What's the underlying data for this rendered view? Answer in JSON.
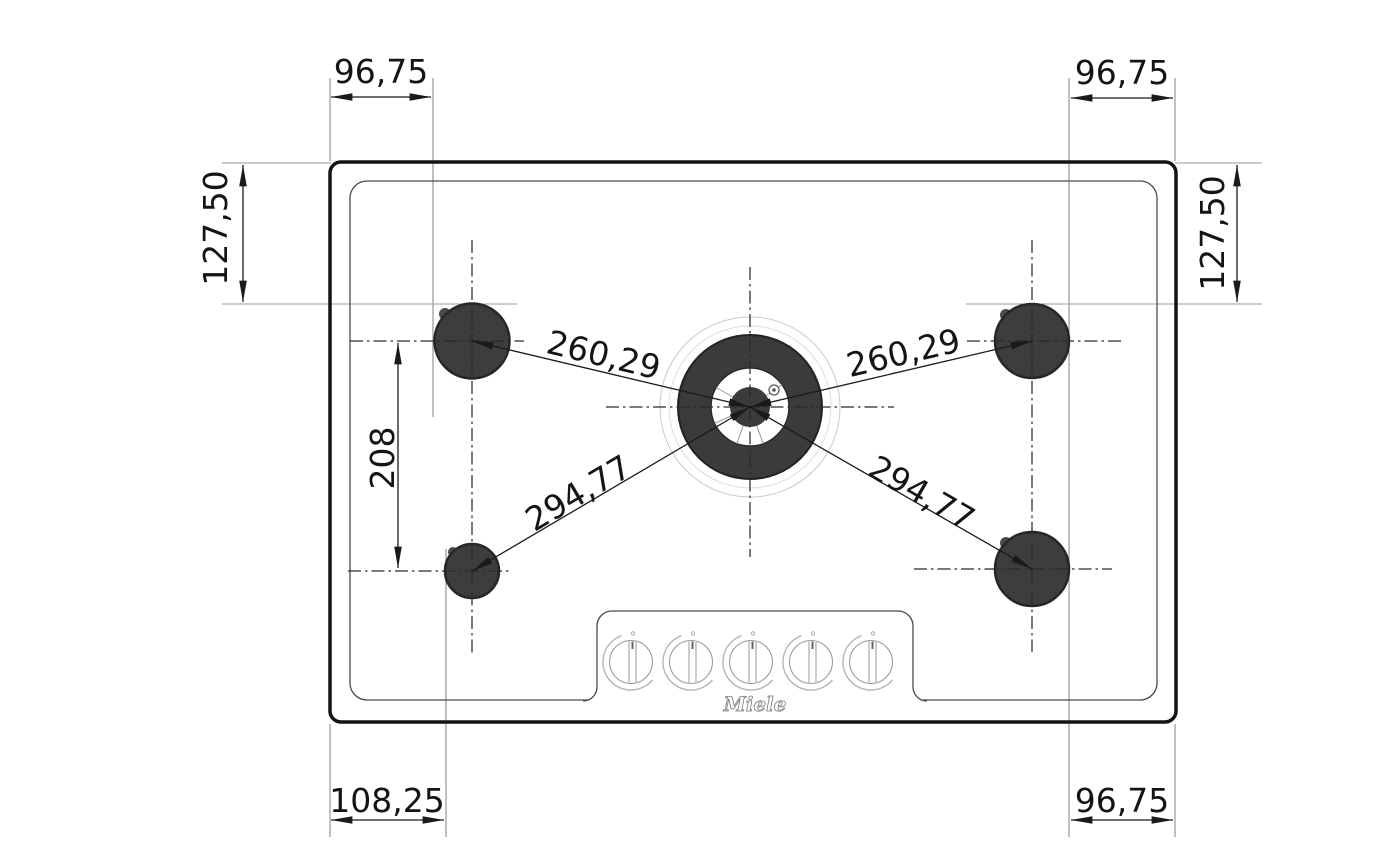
{
  "diagram": {
    "type": "technical-drawing",
    "subject": "Gas cooktop top view with burner spacing dimensions",
    "brand_logo": "Miele",
    "burner_count": 5,
    "knob_count": 5
  },
  "dimensions": {
    "top_left_width": "96,75",
    "top_right_width": "96,75",
    "left_height": "127,50",
    "right_height": "127,50",
    "left_burner_spacing": "208",
    "wok_to_rear_left": "260,29",
    "wok_to_rear_right": "260,29",
    "wok_to_front_left": "294,77",
    "wok_to_front_right": "294,77",
    "bottom_left_width": "108,25",
    "bottom_right_width": "96,75"
  }
}
